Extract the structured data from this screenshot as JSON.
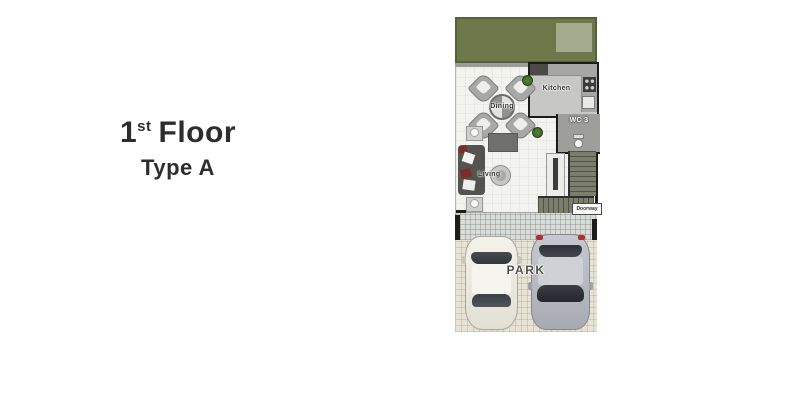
{
  "title_block": {
    "floor_number": "1",
    "floor_suffix": "st",
    "floor_word": "Floor",
    "type_label": "Type A"
  },
  "floor_plan": {
    "rooms": {
      "dining": "Dining",
      "kitchen": "Kitchen",
      "wc": "WC 3",
      "living": "Living",
      "doorway": "Doorway",
      "park": "PARK"
    },
    "colors": {
      "garden": "#6d784a",
      "patio": "#a3ab8c",
      "wall": "#1c1c1a",
      "interior_floor": "#f3f3f0",
      "kitchen_floor": "#c7c7c5",
      "counter": "#a6a6a4",
      "appliance": "#4a4a48",
      "wc_floor": "#9e9e9c",
      "sofa": "#54534e",
      "pillow_accent": "#7b2d26",
      "stairs": "#7b7e6c",
      "apron": "#dadcda",
      "parking_floor": "#e7e4d7",
      "car_glass": "#3a3e42",
      "taillight": "#b22f2f",
      "text": "#2d2d2d",
      "label": "#3a3a38"
    }
  }
}
